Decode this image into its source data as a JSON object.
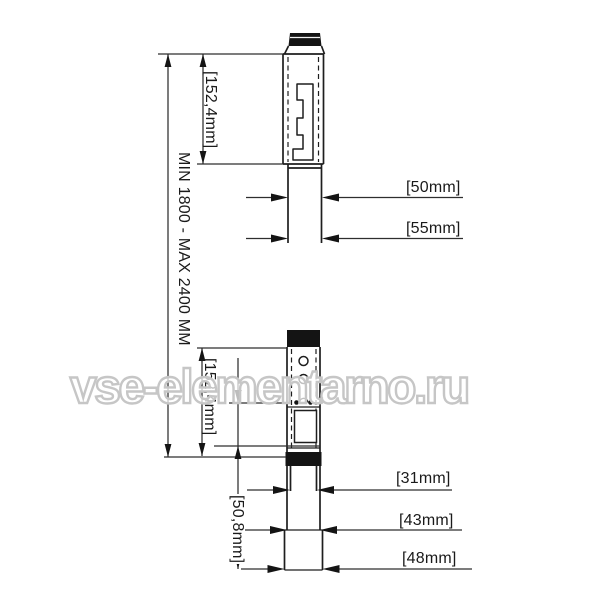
{
  "watermark": {
    "text": "vse-elementarno.ru",
    "color": "#c6c6c6"
  },
  "diagram": {
    "overall_height_label": "MIN 1800 - MAX 2400 MM",
    "upper_view": {
      "rail_height_label": "[152,4mm]",
      "tube_width_label": "[50mm]",
      "lower_tube_width_label": "[55mm]"
    },
    "lower_view": {
      "rail_height_label": "[152,4mm]",
      "bottom_section_height_label": "[50,8mm]",
      "inner_tube_width_label": "[31mm]",
      "middle_tube_width_label": "[43mm]",
      "outer_tube_width_label": "[48mm]"
    },
    "line_color": "#1e1e1e",
    "background": "#ffffff"
  }
}
